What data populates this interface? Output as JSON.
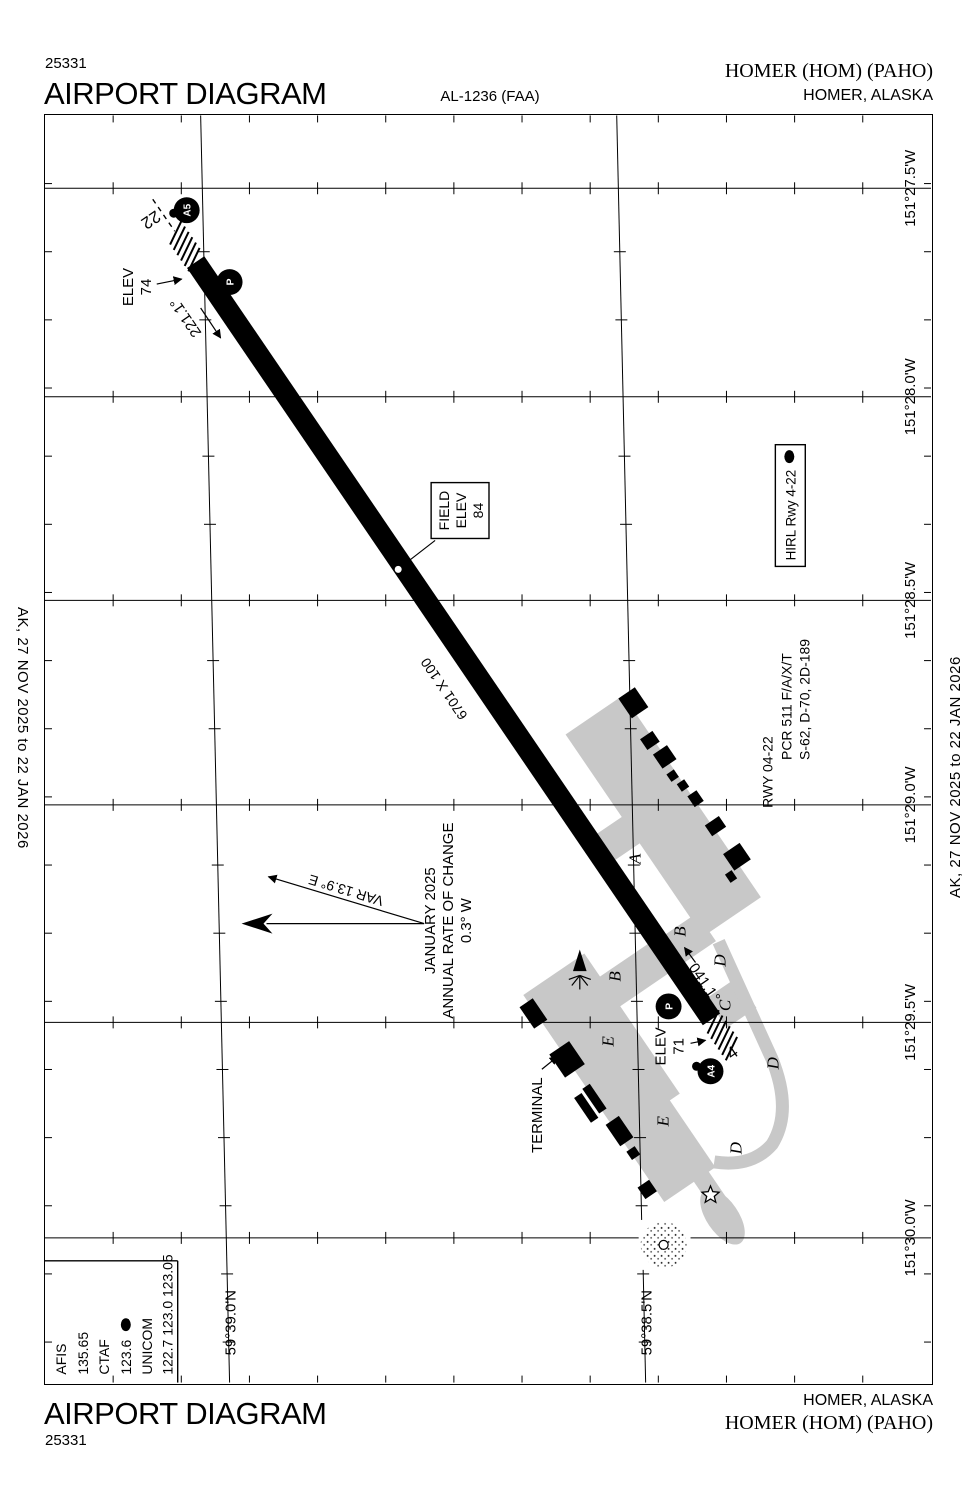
{
  "header": {
    "chart_id": "25331",
    "title": "AIRPORT DIAGRAM",
    "procedure_id": "AL-1236 (FAA)",
    "airport": "HOMER (HOM) (PAHO)",
    "city": "HOMER, ALASKA"
  },
  "footer": {
    "title": "AIRPORT DIAGRAM",
    "chart_id": "25331",
    "city": "HOMER, ALASKA",
    "airport": "HOMER (HOM) (PAHO)"
  },
  "effective_dates": "AK,  27 NOV 2025  to  22 JAN 2026",
  "comm": {
    "afis_label": "AFIS",
    "afis": "135.65",
    "ctaf_label": "CTAF",
    "ctaf": "123.6",
    "pcl": "L",
    "unicom_label": "UNICOM",
    "unicom": "122.7 123.0 123.05"
  },
  "runway": {
    "number_22": "22",
    "number_4": "4",
    "heading_22": "221.1°",
    "heading_4": "041.1°",
    "dimensions": "6701 X 100",
    "elev_label": "ELEV",
    "elev_22": "74",
    "elev_4": "71"
  },
  "field_elev": {
    "line1": "FIELD",
    "line2": "ELEV",
    "value": "84"
  },
  "lighting": {
    "text": "HIRL Rwy 4-22",
    "pcl": "L"
  },
  "runway_data": {
    "line1": "RWY 04-22",
    "line2": "PCR 511 F/A/X/T",
    "line3": "S-62, D-70, 2D-189"
  },
  "variation": {
    "var": "VAR 13.9° E",
    "date": "JANUARY 2025",
    "rate_label": "ANNUAL RATE OF CHANGE",
    "rate_value": "0.3° W"
  },
  "terminal_label": "TERMINAL",
  "taxiway_circles": [
    {
      "label": "A5"
    },
    {
      "label": "P"
    },
    {
      "label": "P"
    },
    {
      "label": "A4"
    }
  ],
  "taxiway_letters": [
    {
      "label": "A"
    },
    {
      "label": "B"
    },
    {
      "label": "B"
    },
    {
      "label": "C"
    },
    {
      "label": "D"
    },
    {
      "label": "D"
    },
    {
      "label": "D"
    },
    {
      "label": "E"
    },
    {
      "label": "E"
    }
  ],
  "coords": {
    "longitudes": [
      "151°27.5'W",
      "151°28.0'W",
      "151°28.5'W",
      "151°29.0'W",
      "151°29.5'W",
      "151°30.0'W"
    ],
    "latitudes": [
      "59°39.0'N",
      "59°38.5'N"
    ]
  },
  "colors": {
    "apron_gray": "#c8c8c8",
    "ink": "#000000"
  }
}
